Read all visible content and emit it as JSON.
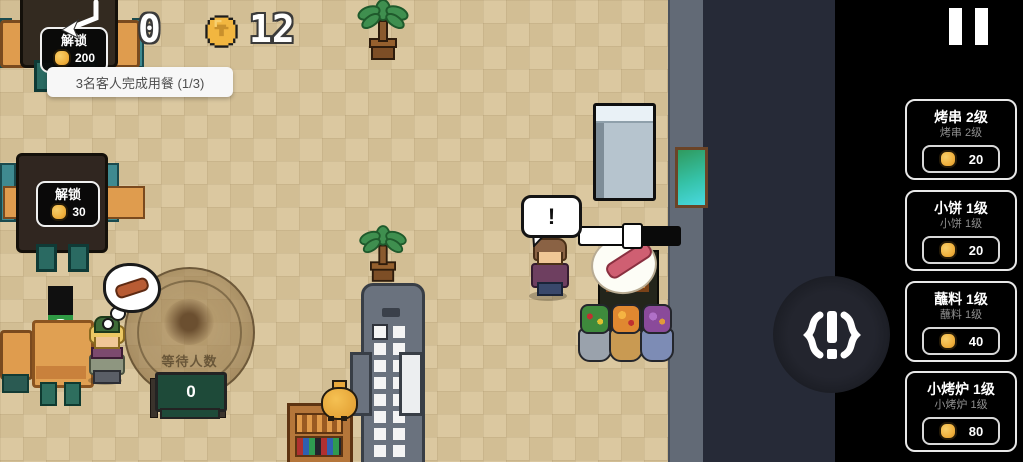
{
  "hud": {
    "served_count": "0",
    "coins": "12"
  },
  "objective_tooltip": {
    "text": "3名客人完成用餐 (1/3)"
  },
  "unlock_buttons": [
    {
      "label": "解锁",
      "cost": "200"
    },
    {
      "label": "解锁",
      "cost": "30"
    }
  ],
  "shop_panel": {
    "items": [
      {
        "title": "烤串 2级",
        "subtitle": "烤串 2级",
        "cost": "20"
      },
      {
        "title": "小饼 1级",
        "subtitle": "小饼 1级",
        "cost": "20"
      },
      {
        "title": "蘸料 1级",
        "subtitle": "蘸料 1级",
        "cost": "40"
      },
      {
        "title": "小烤炉 1级",
        "subtitle": "小烤炉 1级",
        "cost": "80"
      }
    ]
  },
  "scene": {
    "speech_bubble_text": "!",
    "queue_sign": {
      "label": "等待人数",
      "count": "0"
    },
    "grill_progress_percent": 52
  },
  "colors": {
    "floor": "#d8c49c",
    "wall": "#636a75",
    "dark_area": "#262a37",
    "panel_bg": "#000000",
    "coin_gold": "#f0b13e",
    "card_border": "#e8e8e8",
    "progress_fill": "#ffffff"
  }
}
